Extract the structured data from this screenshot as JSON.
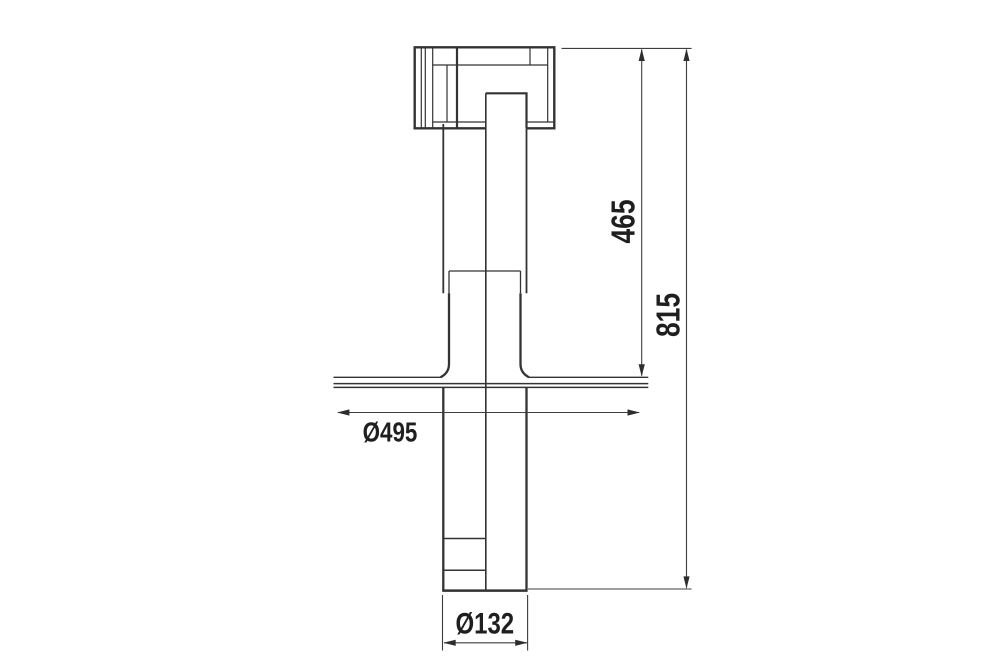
{
  "drawing": {
    "title": "fan-unit-dimensional-drawing",
    "dimensions": {
      "upper_height": "465",
      "total_height": "815",
      "flange_diameter": "Ø495",
      "tube_diameter": "Ø132"
    },
    "colors": {
      "line": "#333333",
      "dimension_line": "#3d3d3d",
      "label": "#1f1f1f",
      "background": "#ffffff"
    }
  }
}
